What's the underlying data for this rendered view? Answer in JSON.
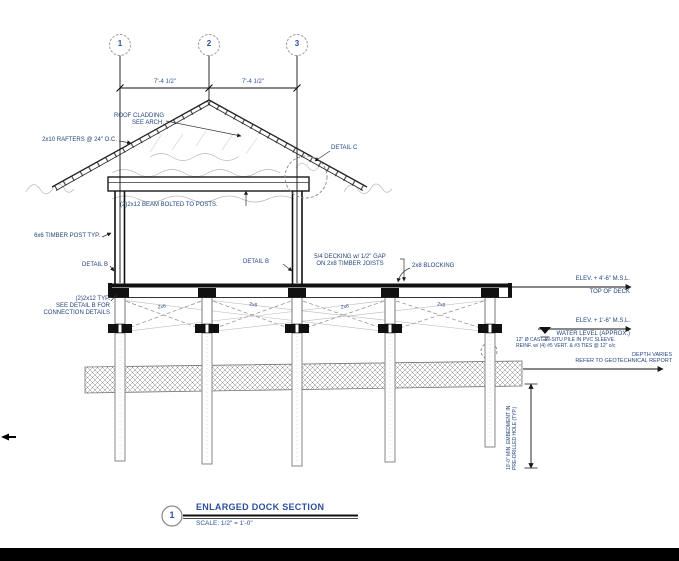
{
  "grid": {
    "bubbles": [
      "1",
      "2",
      "3"
    ]
  },
  "dimensions": {
    "bay_left": "7'-4 1/2\"",
    "bay_right": "7'-4 1/2\"",
    "pile_embedment": "10'-0\" MIN. EMBEDMENT IN\nPRE-DRILLED HOLE (TYP.)"
  },
  "labels": {
    "roof_cladding": "ROOF CLADDING\nSEE ARCH.",
    "rafters": "2x10 RAFTERS @ 24\" O.C.",
    "detail_c": "DETAIL C",
    "beam_bolted": "(2)2x12 BEAM BOLTED TO POSTS.",
    "timber_post": "6x6 TIMBER POST TYP.",
    "detail_b": "DETAIL B",
    "decking": "5/4 DECKING w/ 1/2\" GAP\nON 2x8 TIMBER JOISTS",
    "blocking": "2x8 BLOCKING",
    "beam_typ": "(2)2x12 TYP.\nSEE DETAIL B FOR\nCONNECTION DETAILS",
    "brace": "2x6",
    "elev_deck": {
      "value": "ELEV. + 4'-6\" M.S.L.",
      "name": "TOP OF DECK"
    },
    "elev_water": {
      "value": "ELEV. + 1'-6\" M.S.L.",
      "name": "WATER LEVEL (APPROX.)"
    },
    "pile_note": "12\" Ø CAST-IN-SITU PILE IN PVC SLEEVE.\nREINF. w/ (4) #5 VERT. & #3 TIES @ 12\" o/c",
    "depth_varies": "DEPTH VARIES\nREFER TO GEOTECHNICAL REPORT"
  },
  "title_block": {
    "number": "1",
    "title": "ENLARGED DOCK SECTION",
    "scale": "SCALE: 1/2\" = 1'-0\""
  },
  "colors": {
    "annotation": "#24457e",
    "title": "#2d4f9e",
    "linework": "#1a1a1a",
    "bottom_bar": "#000000"
  }
}
